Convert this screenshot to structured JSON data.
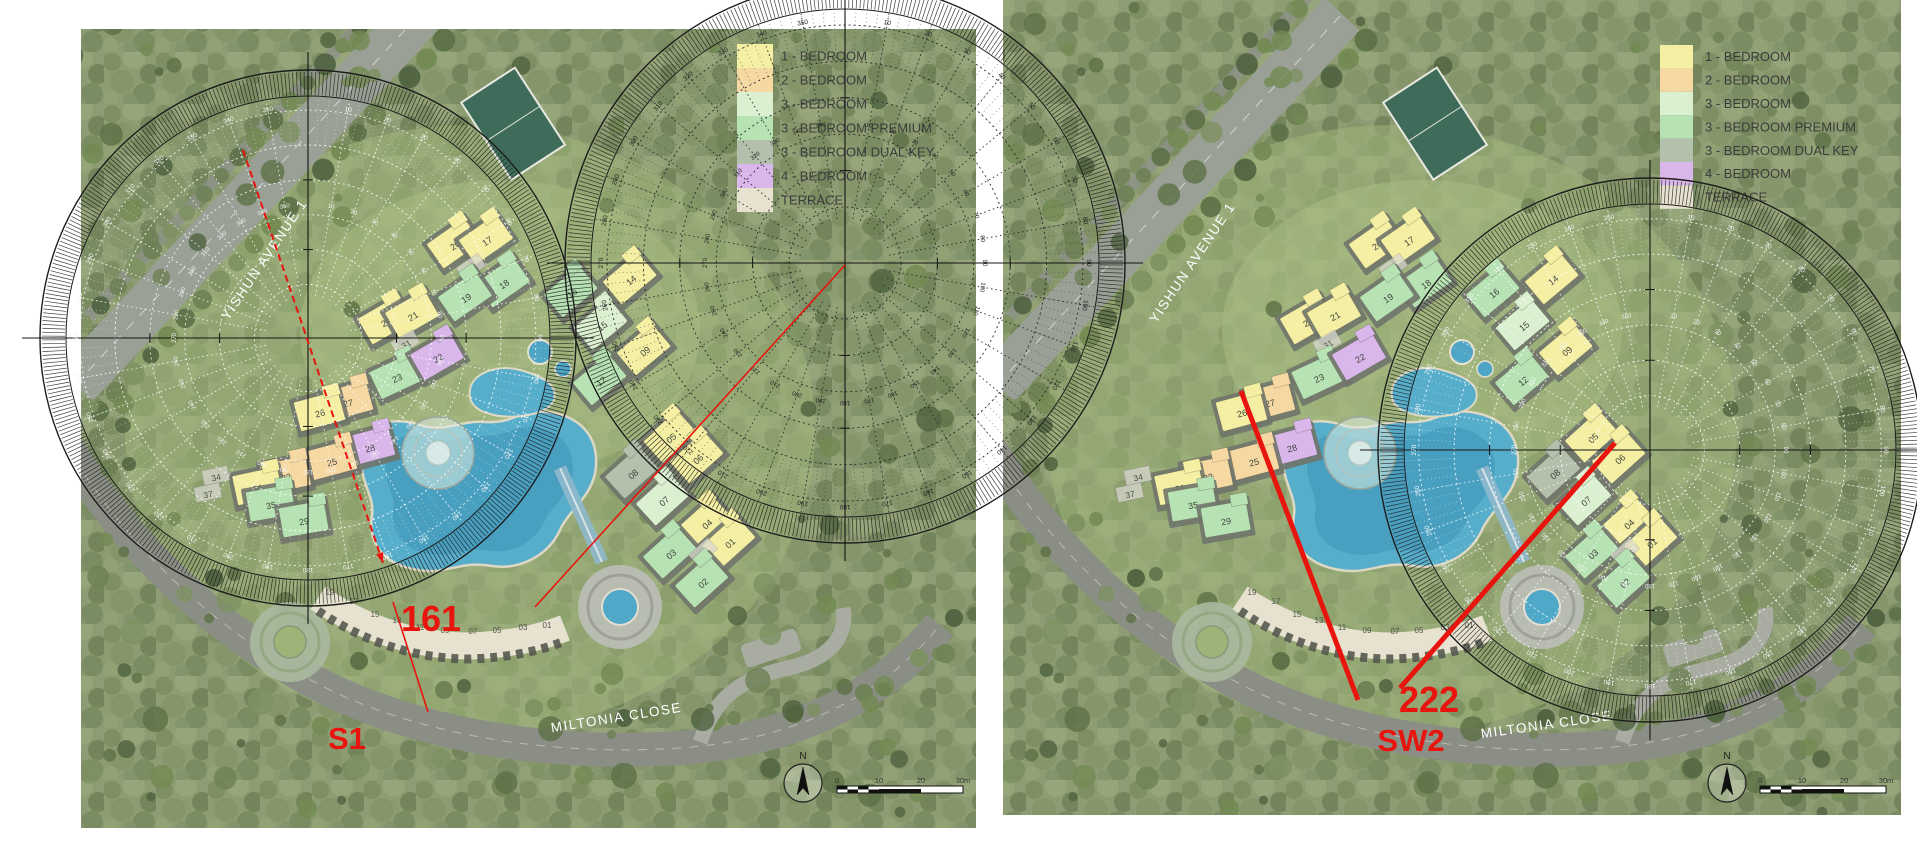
{
  "figure": {
    "description_note": "Two site-plan renderings compared side by side with sun-path overlays",
    "gap": {
      "x1": 976,
      "x2": 1003
    }
  },
  "palette": {
    "y": "#f4efa2",
    "o": "#f6d8a3",
    "g3": "#daf0d0",
    "gp": "#b7e2b3",
    "dk": "#b3c0ab",
    "p": "#d9b7ea",
    "t": "#e7e1cf",
    "red": "#e8150f",
    "road": "#8b8e84",
    "avenue": "#9aa096",
    "forest_base": "#8d9c72",
    "pool": "#57aecb",
    "pool_deep": "#3c93b6"
  },
  "legend": {
    "items": [
      {
        "label": "1 - BEDROOM",
        "color": "#f4efa2"
      },
      {
        "label": "2 - BEDROOM",
        "color": "#f6d8a3"
      },
      {
        "label": "3 - BEDROOM",
        "color": "#daf0d0"
      },
      {
        "label": "3 - BEDROOM PREMIUM",
        "color": "#b7e2b3"
      },
      {
        "label": "3 - BEDROOM DUAL KEY",
        "color": "#b3c0ab"
      },
      {
        "label": "4 - BEDROOM",
        "color": "#d9b7ea"
      },
      {
        "label": "TERRACE",
        "color": "#e7e1cf"
      }
    ]
  },
  "site": {
    "buildings": [
      {
        "n": "20",
        "x": 455,
        "y": 245,
        "c": "y",
        "rot": -35
      },
      {
        "n": "17",
        "x": 487,
        "y": 241,
        "c": "y",
        "rot": -35
      },
      {
        "n": "29",
        "x": 472,
        "y": 268,
        "c": "r",
        "rot": -35
      },
      {
        "n": "18",
        "x": 504,
        "y": 284,
        "c": "gp",
        "rot": -35
      },
      {
        "n": "19",
        "x": 466,
        "y": 298,
        "c": "gp",
        "rot": -35
      },
      {
        "n": "14",
        "x": 631,
        "y": 280,
        "c": "y",
        "rot": -40
      },
      {
        "n": "16",
        "x": 572,
        "y": 293,
        "c": "gp",
        "rot": -40
      },
      {
        "n": "24",
        "x": 386,
        "y": 322,
        "c": "y",
        "rot": -30
      },
      {
        "n": "21",
        "x": 413,
        "y": 316,
        "c": "y",
        "rot": -30
      },
      {
        "n": "31",
        "x": 406,
        "y": 344,
        "c": "r",
        "rot": -30
      },
      {
        "n": "23",
        "x": 397,
        "y": 378,
        "c": "gp",
        "rot": -25
      },
      {
        "n": "22",
        "x": 438,
        "y": 358,
        "c": "p",
        "rot": -30
      },
      {
        "n": "15",
        "x": 602,
        "y": 326,
        "c": "g3",
        "rot": -40
      },
      {
        "n": "12",
        "x": 601,
        "y": 381,
        "c": "gp",
        "rot": -40
      },
      {
        "n": "09",
        "x": 645,
        "y": 351,
        "c": "y",
        "rot": -40
      },
      {
        "n": "27",
        "x": 348,
        "y": 403,
        "c": "o",
        "rot": -15
      },
      {
        "n": "26",
        "x": 320,
        "y": 413,
        "c": "y",
        "rot": -15
      },
      {
        "n": "28",
        "x": 370,
        "y": 448,
        "c": "p",
        "rot": -15
      },
      {
        "n": "25",
        "x": 332,
        "y": 462,
        "c": "o",
        "rot": -15
      },
      {
        "n": "32",
        "x": 286,
        "y": 477,
        "c": "o",
        "rot": -12
      },
      {
        "n": "31",
        "x": 258,
        "y": 488,
        "c": "y",
        "rot": -12
      },
      {
        "n": "34",
        "x": 216,
        "y": 477,
        "c": "r",
        "rot": -12
      },
      {
        "n": "37",
        "x": 208,
        "y": 494,
        "c": "r",
        "rot": -12
      },
      {
        "n": "35",
        "x": 271,
        "y": 505,
        "c": "gp",
        "rot": -10
      },
      {
        "n": "29",
        "x": 304,
        "y": 521,
        "c": "gp",
        "rot": -10
      },
      {
        "n": "05",
        "x": 671,
        "y": 438,
        "c": "y",
        "rot": -42
      },
      {
        "n": "06",
        "x": 698,
        "y": 459,
        "c": "y",
        "rot": -42
      },
      {
        "n": "08",
        "x": 633,
        "y": 474,
        "c": "dk",
        "rot": -42
      },
      {
        "n": "07",
        "x": 664,
        "y": 501,
        "c": "g3",
        "rot": -42
      },
      {
        "n": "04",
        "x": 707,
        "y": 524,
        "c": "y",
        "rot": -42
      },
      {
        "n": "01",
        "x": 730,
        "y": 543,
        "c": "y",
        "rot": -42
      },
      {
        "n": "03",
        "x": 671,
        "y": 554,
        "c": "gp",
        "rot": -42
      },
      {
        "n": "21",
        "x": 704,
        "y": 553,
        "c": "r",
        "rot": -42
      },
      {
        "n": "02",
        "x": 703,
        "y": 583,
        "c": "gp",
        "rot": -42
      }
    ],
    "terrace_units": [
      {
        "n": "19",
        "x": 330,
        "y": 591
      },
      {
        "n": "17",
        "x": 354,
        "y": 600
      },
      {
        "n": "15",
        "x": 375,
        "y": 613
      },
      {
        "n": "13",
        "x": 397,
        "y": 619
      },
      {
        "n": "11",
        "x": 420,
        "y": 626
      },
      {
        "n": "09",
        "x": 445,
        "y": 629
      },
      {
        "n": "07",
        "x": 473,
        "y": 630
      },
      {
        "n": "05",
        "x": 497,
        "y": 629
      },
      {
        "n": "03",
        "x": 523,
        "y": 626
      },
      {
        "n": "01",
        "x": 547,
        "y": 624
      }
    ]
  },
  "sun_diagrams": [
    {
      "id": "left-overlay",
      "cx": 308,
      "cy": 338,
      "r": 268,
      "style": "overlay",
      "tick_labels": "10 to 350 every 10 degrees"
    },
    {
      "id": "center-paper",
      "cx": 845,
      "cy": 263,
      "r": 280,
      "style": "paper",
      "tick_labels": "10 to 350 every 10 degrees"
    },
    {
      "id": "right-overlay",
      "cx": 1650,
      "cy": 450,
      "r": 272,
      "style": "overlay",
      "tick_labels": "10 to 350 every 10 degrees"
    }
  ],
  "panels": [
    {
      "name": "left",
      "offset_x": 0,
      "plan": {
        "x": 81,
        "y": 29,
        "x2": 976,
        "y2": 828
      },
      "legend_pos": {
        "x": 737,
        "y": 44,
        "row_h": 24,
        "swatch_w": 36,
        "text_x": 781,
        "font": 13
      },
      "streets": [
        {
          "text": "YISHUN AVENUE 1",
          "x": 268,
          "y": 262,
          "rot": -56
        },
        {
          "text": "MILTONIA CLOSE",
          "x": 617,
          "y": 722,
          "rot": -9
        }
      ],
      "red_lines": [
        {
          "x1": 243,
          "y1": 150,
          "x2": 383,
          "y2": 563,
          "w": 2,
          "arrow": true,
          "dash": "7 4"
        },
        {
          "x1": 393,
          "y1": 602,
          "x2": 428,
          "y2": 712,
          "w": 1.6
        },
        {
          "x1": 845,
          "y1": 265,
          "x2": 535,
          "y2": 607,
          "w": 1.6
        }
      ],
      "annotations": [
        {
          "text": "161",
          "x": 431,
          "y": 631,
          "size": 36
        },
        {
          "text": "S1",
          "x": 347,
          "y": 749,
          "size": 31
        }
      ],
      "compass": {
        "label": "N",
        "cx": 803,
        "cy": 783,
        "r": 19
      },
      "scale_bar": {
        "x": 837,
        "y": 786,
        "w": 126,
        "labels": [
          "0",
          "10",
          "20",
          "30m"
        ]
      }
    },
    {
      "name": "right",
      "offset_x": 922,
      "plan": {
        "x": 1003,
        "y": 0,
        "x2": 1901,
        "y2": 815
      },
      "legend_pos": {
        "x": 1660,
        "y": 45,
        "row_h": 23.4,
        "swatch_w": 33,
        "text_x": 1705,
        "font": 13
      },
      "streets": [
        {
          "text": "YISHUN AVENUE 1",
          "x": 1196,
          "y": 265,
          "rot": -56
        },
        {
          "text": "MILTONIA CLOSE",
          "x": 1547,
          "y": 729,
          "rot": -8
        }
      ],
      "red_lines": [
        {
          "x1": 1241,
          "y1": 391,
          "x2": 1358,
          "y2": 700,
          "w": 5
        },
        {
          "x1": 1615,
          "y1": 443,
          "x2": 1400,
          "y2": 688,
          "w": 5
        }
      ],
      "annotations": [
        {
          "text": "222",
          "x": 1429,
          "y": 712,
          "size": 36
        },
        {
          "text": "SW2",
          "x": 1411,
          "y": 751,
          "size": 31
        }
      ],
      "compass": {
        "label": "N",
        "cx": 1727,
        "cy": 783,
        "r": 19
      },
      "scale_bar": {
        "x": 1760,
        "y": 786,
        "w": 126,
        "labels": [
          "0",
          "10",
          "20",
          "30m"
        ]
      }
    }
  ]
}
